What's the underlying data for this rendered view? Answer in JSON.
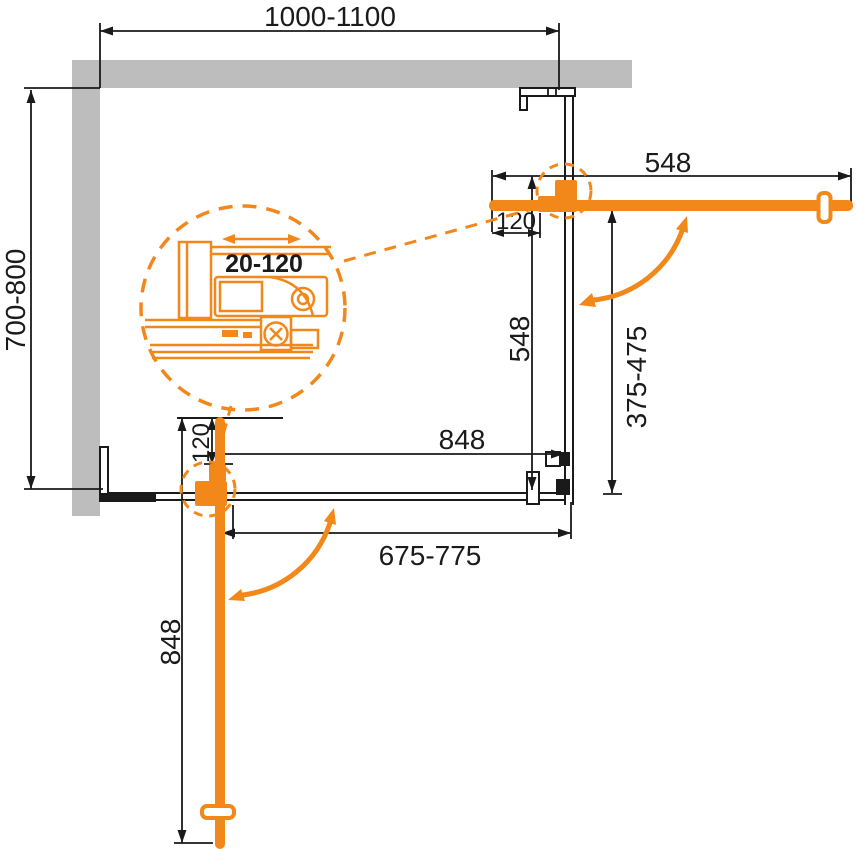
{
  "diagram": {
    "title": "corner-shower-enclosure-plan",
    "colors": {
      "accent_orange": "#F2871A",
      "wall_gray": "#BDBDBD",
      "line_black": "#1A1A1A",
      "background": "#FFFFFF"
    },
    "dims": {
      "top_width": "1000-1100",
      "side_depth": "700-800",
      "door_right_width": "548",
      "door_right_profile": "120",
      "door_right_length": "548",
      "panel_right_range": "375-475",
      "door_bottom_span": "848",
      "door_bottom_profile": "120",
      "panel_bottom_range": "675-775",
      "door_bottom_length": "848",
      "hinge_adjust_range": "20-120"
    }
  }
}
